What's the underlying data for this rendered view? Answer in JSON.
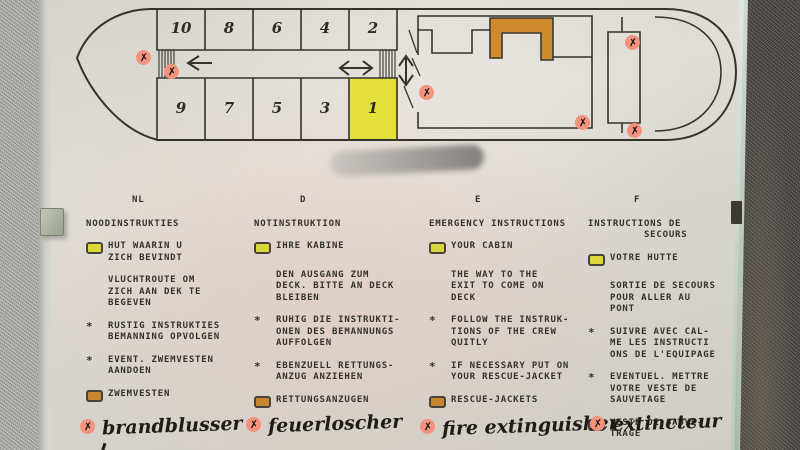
{
  "ui": {
    "bullet_char": "*",
    "marker_glyph": "✗"
  },
  "colors": {
    "highlight_yellow": "#e4df3a",
    "structure_orange": "#cf8a2e",
    "marker_pink": "#f2937d",
    "ink": "#33312c",
    "paper": "#dbd8d1"
  },
  "diagram": {
    "cabins_top": [
      "10",
      "8",
      "6",
      "4",
      "2"
    ],
    "cabins_bottom": [
      "9",
      "7",
      "5",
      "3",
      "1"
    ],
    "highlighted_cabin": "1"
  },
  "columns": [
    {
      "lang": "NL",
      "title_lines": [
        "NOODINSTRUKTIES"
      ],
      "items": [
        {
          "icon": "cabin-location-icon",
          "lines": [
            "HUT WAARIN U",
            "ZICH BEVINDT"
          ]
        },
        {
          "icon": null,
          "lines": [
            "VLUCHTROUTE OM",
            "ZICH AAN DEK TE",
            "BEGEVEN"
          ]
        },
        {
          "icon": "star-bullet",
          "lines": [
            "RUSTIG INSTRUKTIES",
            "BEMANNING OPVOLGEN"
          ]
        },
        {
          "icon": "star-bullet",
          "lines": [
            "EVENT. ZWEMVESTEN",
            "AANDOEN"
          ]
        },
        {
          "icon": "life-jacket-icon",
          "lines": [
            "ZWEMVESTEN"
          ]
        }
      ],
      "handwritten": "brandblusser"
    },
    {
      "lang": "D",
      "title_lines": [
        "NOTINSTRUKTION"
      ],
      "items": [
        {
          "icon": "cabin-location-icon",
          "lines": [
            "IHRE KABINE"
          ]
        },
        {
          "icon": null,
          "lines": [
            "DEN AUSGANG ZUM",
            "DECK. BITTE AN DECK",
            "BLEIBEN"
          ]
        },
        {
          "icon": "star-bullet",
          "lines": [
            "RUHIG DIE INSTRUKTI-",
            "ONEN DES BEMANNUNGS",
            "AUFFOLGEN"
          ]
        },
        {
          "icon": "star-bullet",
          "lines": [
            "EBENZUELL RETTUNGS-",
            "ANZUG ANZIEHEN"
          ]
        },
        {
          "icon": "life-jacket-icon",
          "lines": [
            "RETTUNGSANZUGEN"
          ]
        }
      ],
      "handwritten": "feuerloscher"
    },
    {
      "lang": "E",
      "title_lines": [
        "EMERGENCY INSTRUCTIONS"
      ],
      "items": [
        {
          "icon": "cabin-location-icon",
          "lines": [
            "YOUR CABIN"
          ]
        },
        {
          "icon": null,
          "lines": [
            "THE WAY TO THE",
            "EXIT TO COME ON",
            "DECK"
          ]
        },
        {
          "icon": "star-bullet",
          "lines": [
            "FOLLOW THE INSTRUK-",
            "TIONS OF THE CREW",
            "QUITLY"
          ]
        },
        {
          "icon": "star-bullet",
          "lines": [
            "IF NECESSARY PUT ON",
            "YOUR RESCUE-JACKET"
          ]
        },
        {
          "icon": "life-jacket-icon",
          "lines": [
            "RESCUE-JACKETS"
          ]
        }
      ],
      "handwritten": "fire extinguisher"
    },
    {
      "lang": "F",
      "title_lines": [
        "INSTRUCTIONS DE",
        "         SECOURS"
      ],
      "items": [
        {
          "icon": "cabin-location-icon",
          "lines": [
            "VOTRE HUTTE"
          ]
        },
        {
          "icon": null,
          "lines": [
            "SORTIE DE SECOURS",
            "POUR ALLER AU",
            "PONT"
          ]
        },
        {
          "icon": "star-bullet",
          "lines": [
            "SUIVRE AVEC CAL-",
            "ME LES INSTRUCTI",
            "ONS DE L'EQUIPAGE"
          ]
        },
        {
          "icon": "star-bullet",
          "lines": [
            "EVENTUEL. METTRE",
            "VOTRE VESTE DE",
            "SAUVETAGE"
          ]
        },
        {
          "icon": "life-jacket-icon",
          "lines": [
            "VESTE DE SAUVE-",
            "TRAGE"
          ]
        }
      ],
      "handwritten": "extincteur"
    }
  ]
}
